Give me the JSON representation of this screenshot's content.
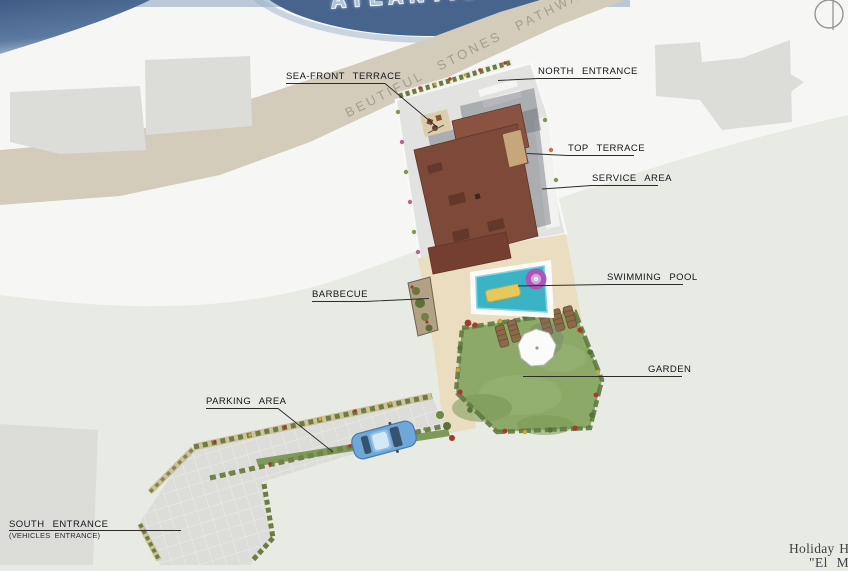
{
  "plan": {
    "ocean_label": "ATLANTIC OCEAN",
    "pathway_label": "BEUTIFUL STONES PATHWAY",
    "callouts": {
      "sea_front_terrace": "SEA-FRONT TERRACE",
      "north_entrance": "NORTH ENTRANCE",
      "top_terrace": "TOP TERRACE",
      "service_area": "SERVICE AREA",
      "swimming_pool": "SWIMMING POOL",
      "barbecue": "BARBECUE",
      "garden": "GARDEN",
      "parking_area": "PARKING AREA",
      "south_entrance": "SOUTH ENTRANCE",
      "south_entrance_sub": "(VEHICLES ENTRANCE)"
    },
    "title_block": {
      "line1": "Holiday H",
      "line2": "\"El M"
    },
    "colors": {
      "ocean": "#46648c",
      "sand_path": "#d3ccbb",
      "roof_brown": "#7d4938",
      "pool_water": "#3ab3c6",
      "lawn_green": "#8ca968",
      "car_blue": "#6fa8d8"
    }
  }
}
